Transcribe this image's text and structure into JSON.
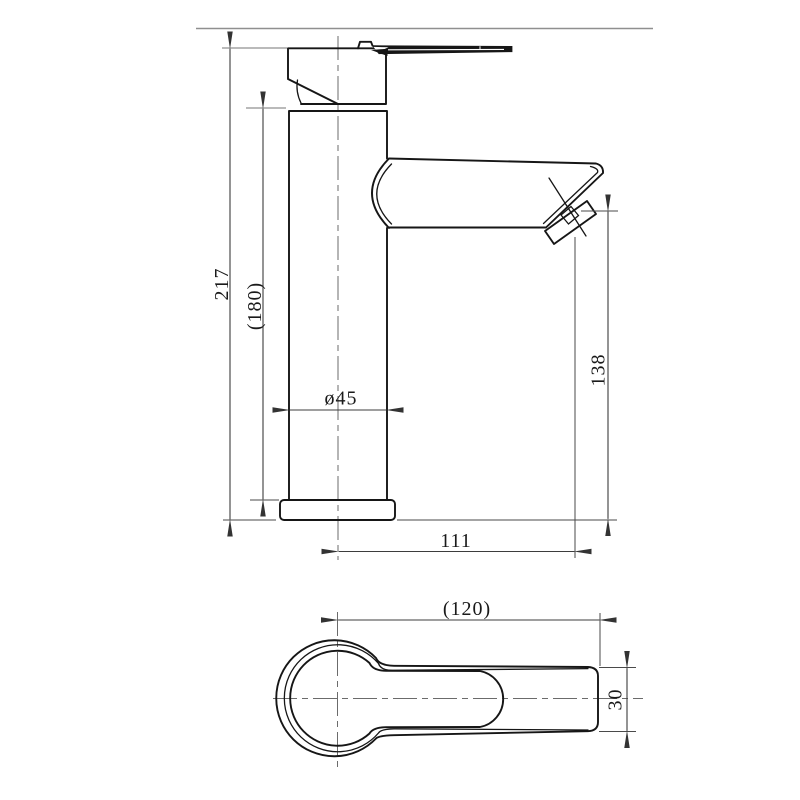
{
  "title": "Single-lever basin mixer tap — dimensional drawing",
  "views": {
    "front": "front elevation",
    "top": "plan view"
  },
  "dimensions": {
    "total_height": "217",
    "height_to_spout_base": "(180)",
    "body_diameter": "ø45",
    "outlet_height": "138",
    "spout_reach": "111",
    "overall_length": "(120)",
    "handle_width": "30"
  },
  "colors": {
    "object_line": "#161616",
    "dimension_line": "#3d3d3d",
    "extension_gray": "#a3a3a3",
    "divider": "#8f8f8f",
    "background": "#ffffff",
    "text": "#1a1a1a"
  }
}
